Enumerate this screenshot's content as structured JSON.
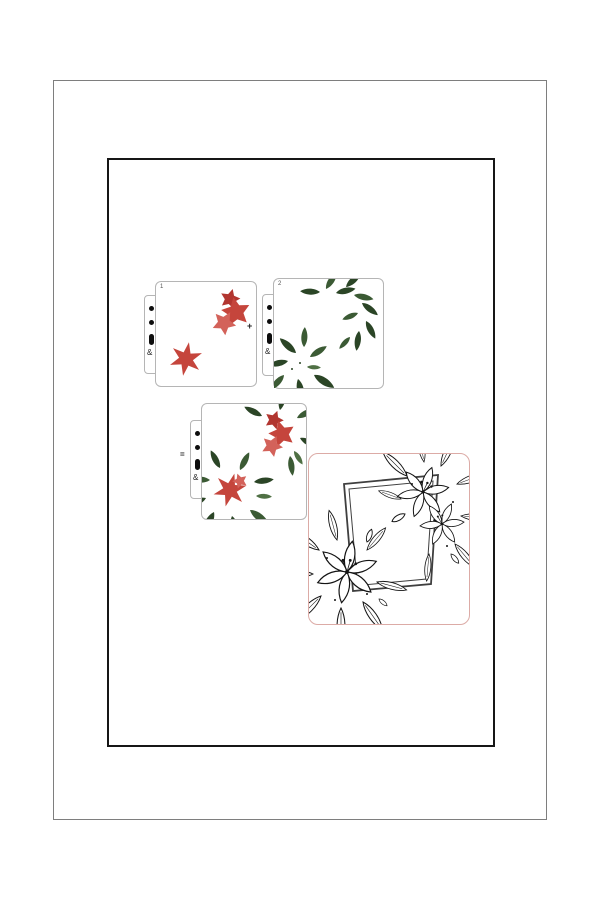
{
  "colors": {
    "outerBorder": "#7e7e7e",
    "innerBorder": "#161616",
    "cardBorder": "#b5b5b5",
    "flowerRed": "#c5453c",
    "flowerRedLight": "#d3625a",
    "flowerRedDark": "#b23630",
    "leafGreen": "#3b5a34",
    "leafGreenDark": "#2b4526",
    "leafGreenLight": "#4f7044",
    "previewPink": "#dcaba6",
    "frameGray": "#3f3f3f",
    "lineArt": "#141414"
  },
  "stencil1": {
    "label": "1",
    "binder_mark": "&"
  },
  "stencil2": {
    "label": "2",
    "binder_mark": "&"
  },
  "stencil_result": {
    "binder_mark": "&"
  },
  "operators": {
    "plus": "+",
    "equals": "="
  }
}
